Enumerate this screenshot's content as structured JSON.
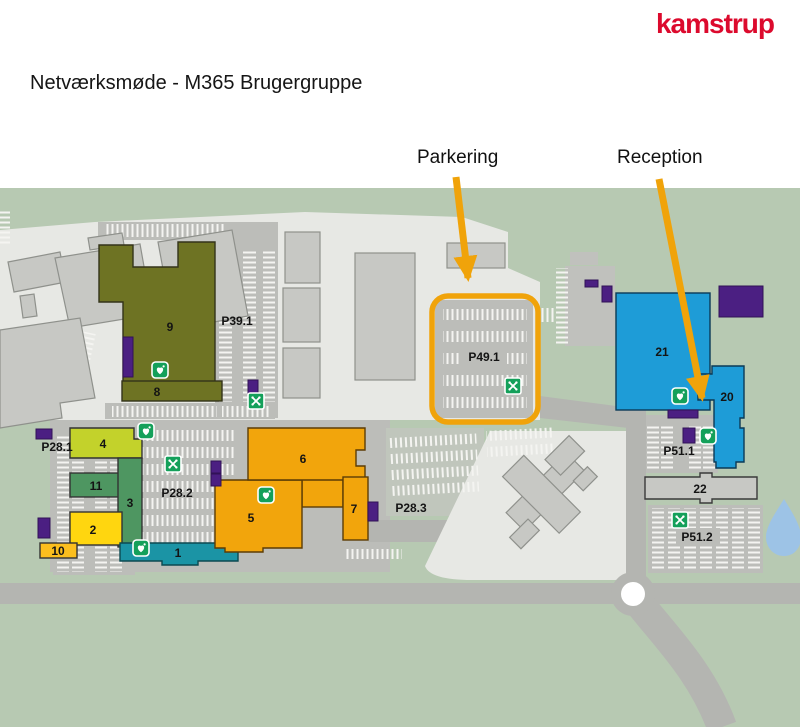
{
  "header": {
    "logo": "kamstrup",
    "title": "Netværksmøde - M365 Brugergruppe"
  },
  "map": {
    "annotations": {
      "parkering": "Parkering",
      "reception": "Reception"
    },
    "buildings": [
      {
        "label": "9",
        "color": "#6e7323"
      },
      {
        "label": "8",
        "color": "#6e7323"
      },
      {
        "label": "4",
        "color": "#c3d22b"
      },
      {
        "label": "11",
        "color": "#4e9661"
      },
      {
        "label": "3",
        "color": "#4e9661"
      },
      {
        "label": "2",
        "color": "#ffd60f"
      },
      {
        "label": "10",
        "color": "#fcbf1e"
      },
      {
        "label": "1",
        "color": "#1b94a5"
      },
      {
        "label": "5",
        "color": "#f2a50c"
      },
      {
        "label": "6",
        "color": "#f2a50c"
      },
      {
        "label": "7",
        "color": "#f2a50c"
      },
      {
        "label": "21",
        "color": "#1e9cd7"
      },
      {
        "label": "20",
        "color": "#1e9cd7"
      },
      {
        "label": "22",
        "color": "#c7c8c4"
      }
    ],
    "parkings": [
      {
        "label": "P39.1"
      },
      {
        "label": "P28.1"
      },
      {
        "label": "P28.2"
      },
      {
        "label": "P28.3"
      },
      {
        "label": "P49.1"
      },
      {
        "label": "P51.1"
      },
      {
        "label": "P51.2"
      }
    ],
    "icons": {
      "aed": "defibrillator-aed",
      "assembly": "assembly-point"
    },
    "colors": {
      "ground": "#b7c9b2",
      "paved": "#e7e8e4",
      "parking": "#bcbdb9",
      "road": "#b4b5b1",
      "highlight": "#f0a30a",
      "purple": "#4b1f82",
      "water": "#9dc3e6",
      "icon_green": "#14a05a",
      "logo_red": "#dc0a2d"
    }
  }
}
